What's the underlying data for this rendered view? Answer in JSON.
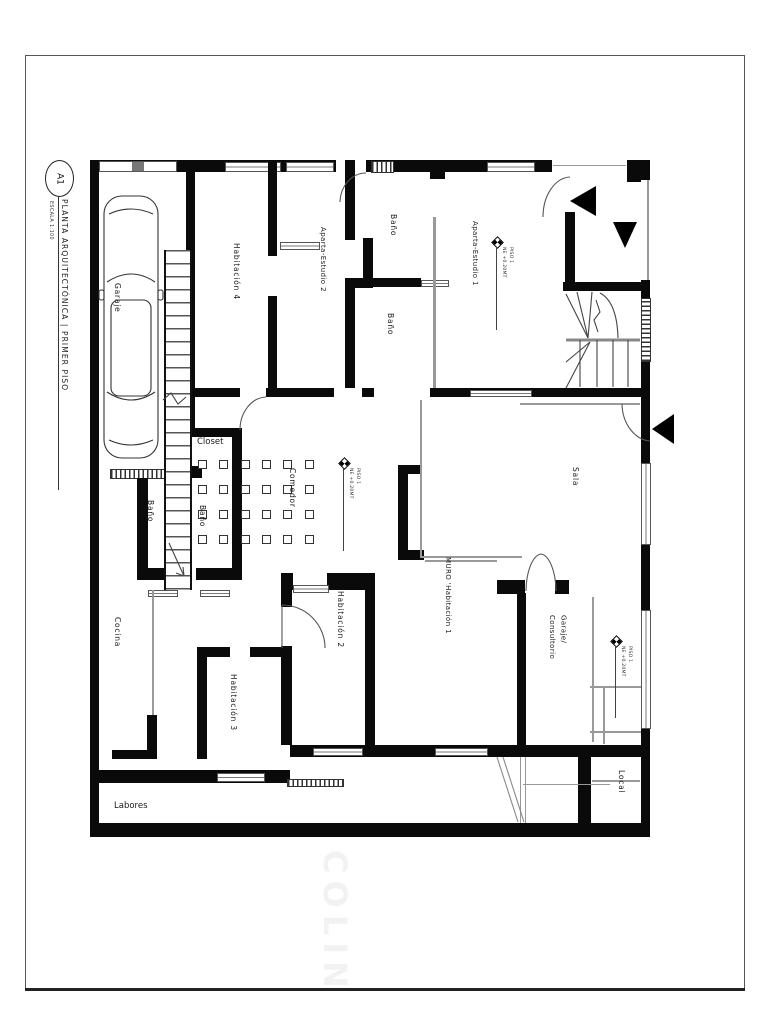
{
  "title_block": {
    "code": "A1",
    "title": "PLANTA ARQUITECTÓNICA | PRIMER PISO",
    "scale": "ESCALA 1:100"
  },
  "watermark": "COLIN",
  "rooms": {
    "garaje": "Garaje",
    "habitacion4": "Habitación 4",
    "aparta_estudio2": "Aparta-Estudio 2",
    "bano_top": "Baño",
    "bano_mid": "Baño",
    "aparta_estudio1": "Aparta-Estudio 1",
    "closet": "Closet",
    "comedor": "Comedor",
    "sala": "Sala",
    "bano_izq1": "Baño",
    "bano_izq2": "Baño",
    "cocina": "Cocina",
    "habitacion3": "Habitación 3",
    "habitacion2": "Habitación 2",
    "muro_habitacion1": "MURO 'Habitación 1",
    "garaje_consultorio_l1": "Garaje/",
    "garaje_consultorio_l2": "Consultorio",
    "local": "Local",
    "labores": "Labores"
  },
  "level_markers": [
    {
      "line1": "PISO 1",
      "line2": "NE +0.20MT"
    },
    {
      "line1": "PISO 1",
      "line2": "NE +0.20MT"
    },
    {
      "line1": "PISO 1",
      "line2": "NE +0.20MT"
    }
  ]
}
